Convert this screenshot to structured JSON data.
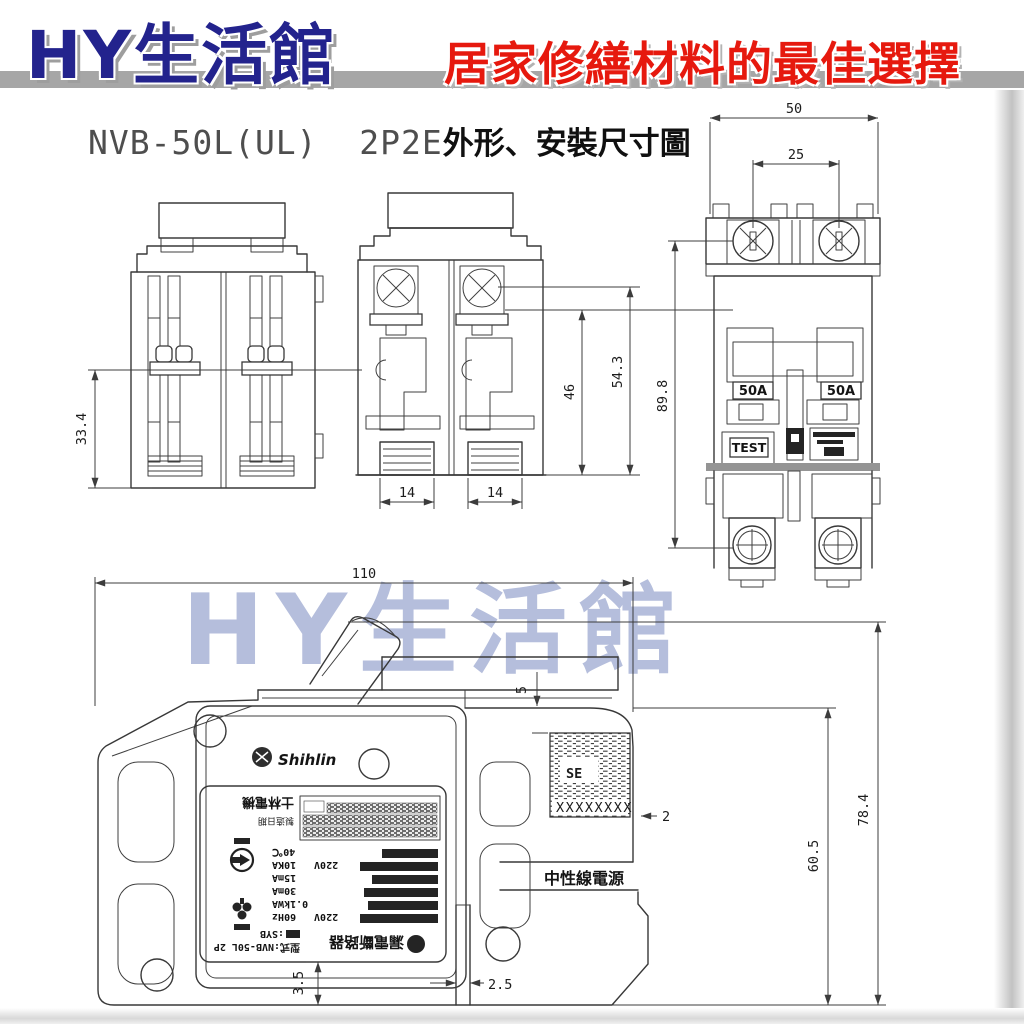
{
  "header": {
    "store_name": "HY生活館",
    "tagline": "居家修繕材料的最佳選擇"
  },
  "title": {
    "model": "NVB-50L(UL)  2P2E",
    "suffix": "外形、安裝尺寸圖"
  },
  "watermark": "HY生活館",
  "colors": {
    "brand_blue": "#23238d",
    "brand_red": "#e6190e",
    "watermark_lavender": "#b5bedc",
    "line_gray": "#383838"
  },
  "views": {
    "rear": {
      "height": "33.4"
    },
    "side": {
      "inner_height": "46",
      "total_height": "54.3",
      "foot_left": "14",
      "foot_right": "14"
    },
    "front": {
      "width": "50",
      "pole_pitch": "25",
      "height": "89.8",
      "amp_left": "50A",
      "amp_right": "50A",
      "test_label": "TEST"
    },
    "mounted": {
      "width": "110",
      "top_gap": "5",
      "label_edge": "2",
      "depth_inner": "60.5",
      "depth_total": "78.4",
      "bottom_gap": "3.5",
      "slot_width": "2.5",
      "brand": "Shihlin",
      "se_mark": "SE",
      "serial": "XXXXXXXX",
      "neutral_label": "中性線電源"
    }
  },
  "nameplate": {
    "product": "漏電斷路器",
    "model_row": "型式:NVB-50L 2P",
    "frame": ":SYB",
    "volt_main": "220V",
    "freq": "60Hz",
    "power": "0.1kWA",
    "sens_rated": "30mA",
    "sens_hold": "15mA",
    "volt_sub": "220V",
    "breaking": "10KA",
    "temp": "40℃",
    "maker": "士林電機",
    "date_label": "製造日期"
  }
}
